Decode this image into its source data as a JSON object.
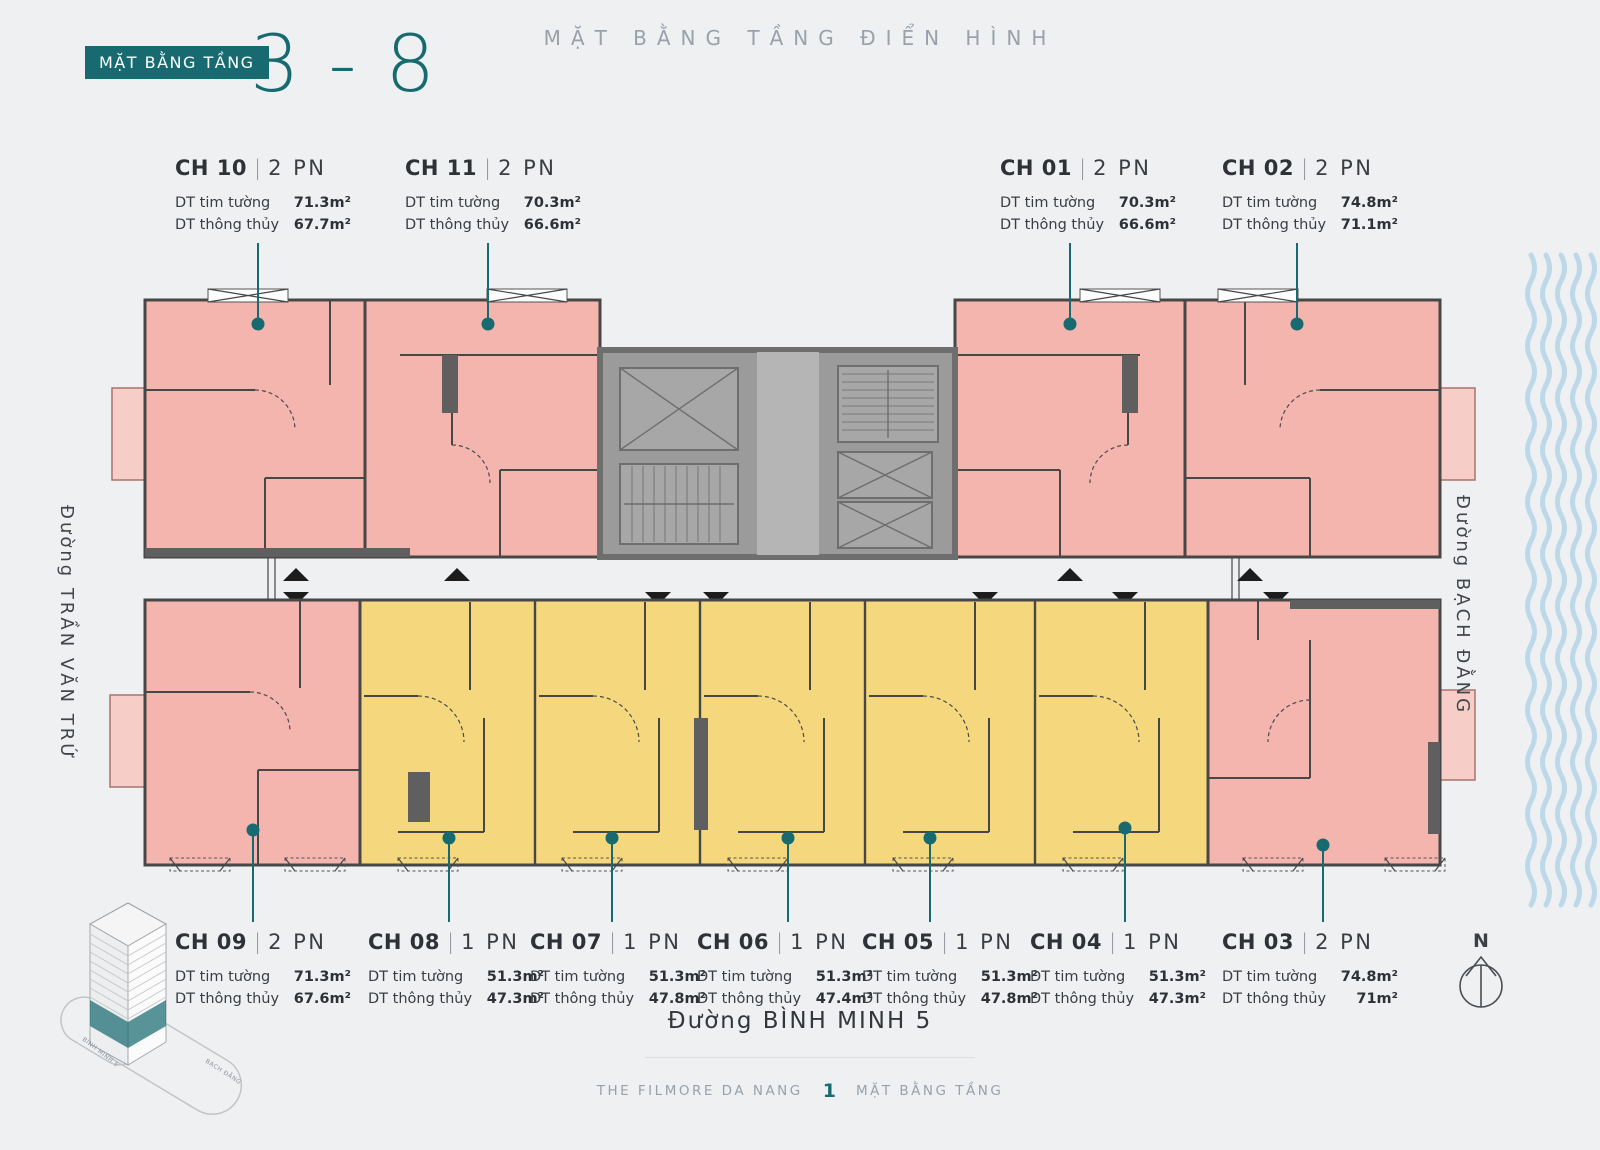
{
  "header": {
    "badge": "MẶT BẰNG TẦNG",
    "floor_range": "3 - 8",
    "title": "MẶT BẰNG TẦNG ĐIỂN HÌNH"
  },
  "streets": {
    "left": "Đường TRẦN VĂN TRỨ",
    "right": "Đường BẠCH ĐẰNG",
    "bottom": "Đường BÌNH MINH 5"
  },
  "legend_labels": {
    "tim_tuong": "DT tim tường",
    "thong_thuy": "DT thông thủy"
  },
  "units": [
    {
      "id": "CH 10",
      "type": "2 PN",
      "tim_tuong": "71.3m²",
      "thong_thuy": "67.7m²",
      "color": "pink",
      "row": "top"
    },
    {
      "id": "CH 11",
      "type": "2 PN",
      "tim_tuong": "70.3m²",
      "thong_thuy": "66.6m²",
      "color": "pink",
      "row": "top"
    },
    {
      "id": "CH 01",
      "type": "2 PN",
      "tim_tuong": "70.3m²",
      "thong_thuy": "66.6m²",
      "color": "pink",
      "row": "top"
    },
    {
      "id": "CH 02",
      "type": "2 PN",
      "tim_tuong": "74.8m²",
      "thong_thuy": "71.1m²",
      "color": "pink",
      "row": "top"
    },
    {
      "id": "CH 09",
      "type": "2 PN",
      "tim_tuong": "71.3m²",
      "thong_thuy": "67.6m²",
      "color": "pink",
      "row": "bottom"
    },
    {
      "id": "CH 08",
      "type": "1 PN",
      "tim_tuong": "51.3m²",
      "thong_thuy": "47.3m²",
      "color": "yellow",
      "row": "bottom"
    },
    {
      "id": "CH 07",
      "type": "1 PN",
      "tim_tuong": "51.3m²",
      "thong_thuy": "47.8m²",
      "color": "yellow",
      "row": "bottom"
    },
    {
      "id": "CH 06",
      "type": "1 PN",
      "tim_tuong": "51.3m²",
      "thong_thuy": "47.4m²",
      "color": "yellow",
      "row": "bottom"
    },
    {
      "id": "CH 05",
      "type": "1 PN",
      "tim_tuong": "51.3m²",
      "thong_thuy": "47.8m²",
      "color": "yellow",
      "row": "bottom"
    },
    {
      "id": "CH 04",
      "type": "1 PN",
      "tim_tuong": "51.3m²",
      "thong_thuy": "47.3m²",
      "color": "yellow",
      "row": "bottom"
    },
    {
      "id": "CH 03",
      "type": "2 PN",
      "tim_tuong": "74.8m²",
      "thong_thuy": "71m²",
      "color": "pink",
      "row": "bottom"
    }
  ],
  "compass": {
    "north_label": "N"
  },
  "building_thumb": {
    "street_label_left": "BÌNH MINH 5",
    "street_label_right": "BẠCH ĐẰNG"
  },
  "footer": {
    "project": "THE FILMORE DA NANG",
    "page_number": "1",
    "section": "MẶT BẰNG TẦNG"
  },
  "colors": {
    "teal": "#176b70",
    "pink_unit": "#f4b5ae",
    "pink_light": "#f7cdc7",
    "yellow_unit": "#f5d87d",
    "core_gray": "#9b9b9b",
    "water": "#bdd8e8",
    "background": "#eef0f2",
    "text_dark": "#2e3236",
    "text_muted": "#9aa1a8"
  }
}
